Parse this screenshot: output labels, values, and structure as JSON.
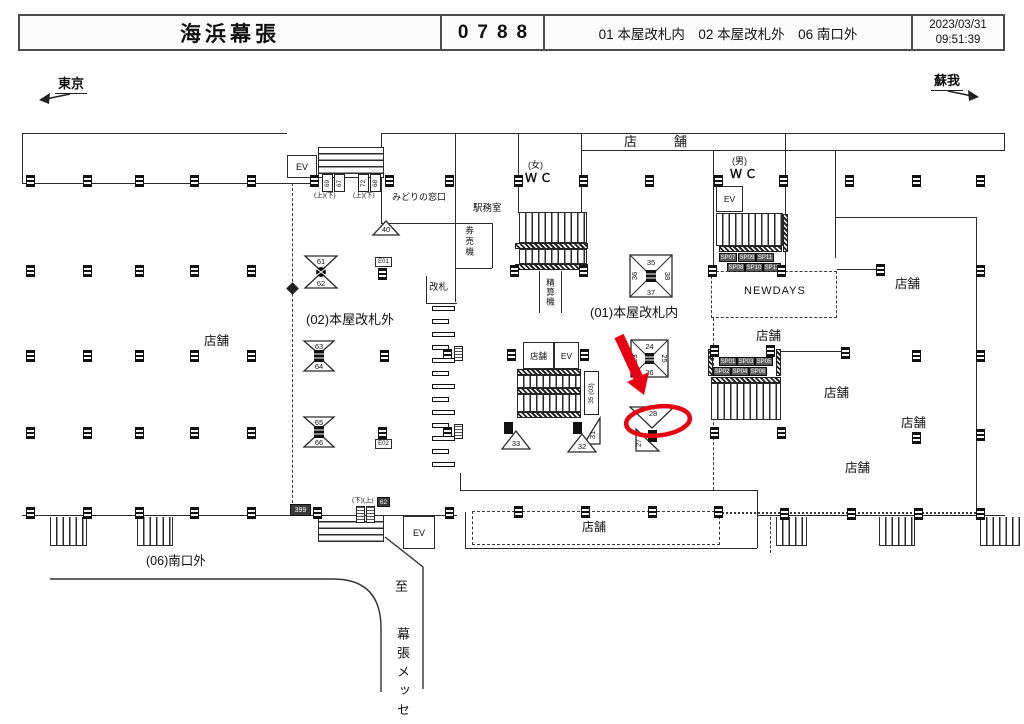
{
  "header": {
    "station": "海浜幕張",
    "code": "0788",
    "locations": "01 本屋改札内　02 本屋改札外　06 南口外",
    "date": "2023/03/31",
    "time": "09:51:39"
  },
  "nav": {
    "left": "東京",
    "right": "蘇我"
  },
  "areas": {
    "a01": "(01)本屋改札内",
    "a02": "(02)本屋改札外",
    "a06": "(06)南口外"
  },
  "rooms": {
    "midori": "みどりの窓口",
    "office": "駅務室",
    "ticket_machine": "券売機",
    "gate": "改札",
    "fare_machine": "精算機",
    "wc": "ＷＣ",
    "female": "(女)",
    "male": "(男)",
    "ev": "EV",
    "newdays": "NEWDAYS",
    "shop": "店舗",
    "shop_wide": "店　舗"
  },
  "stairs": {
    "up_down": "(上)(下)",
    "down_up": "(下)(上)"
  },
  "dest": {
    "to": "至",
    "place": "幕張メッセ"
  },
  "signs": {
    "n40": "40",
    "n61": "61",
    "n62": "62",
    "n63": "63",
    "n64": "64",
    "n65": "65",
    "n66": "66",
    "e01": "E01",
    "e02": "E02",
    "n23": "23",
    "n24": "24",
    "n25": "25",
    "n26": "26",
    "n35": "35",
    "n36": "36",
    "n37": "37",
    "n38": "38",
    "n27": "27",
    "n28": "28",
    "n31": "31",
    "n32": "32",
    "n33": "33",
    "n69": "69",
    "n67": "67",
    "n72": "72",
    "n68": "68",
    "n399": "399",
    "n62b": "62",
    "side_sign": "35 (03)",
    "sp01": "SP01",
    "sp02": "SP02",
    "sp03": "SP03",
    "sp04": "SP04",
    "sp05": "SP05",
    "sp06": "SP06",
    "sp07": "SP07",
    "sp08": "SP08",
    "sp09": "SP09",
    "sp10": "SP10",
    "sp11": "SP11",
    "sp12": "SP12"
  }
}
